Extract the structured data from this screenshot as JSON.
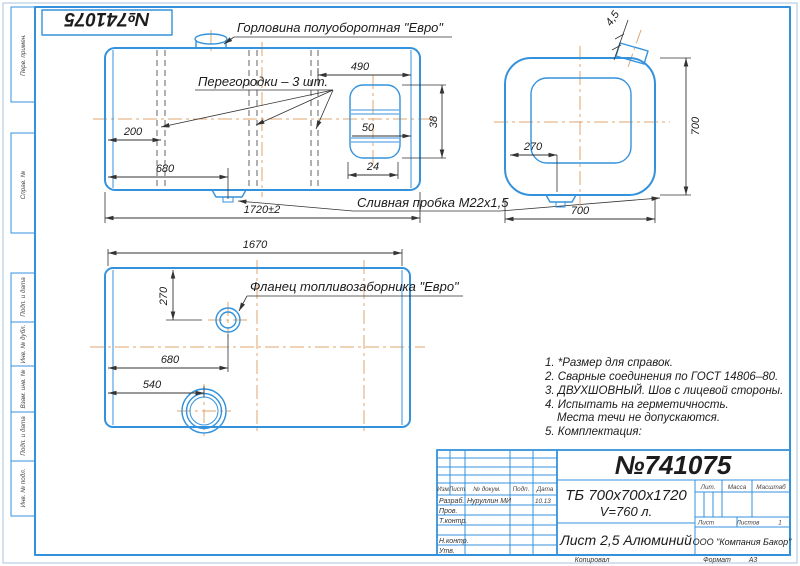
{
  "stamp": {
    "number": "№741075"
  },
  "margin": {
    "labels": [
      "Перв. примен.",
      "Справ. №",
      "Подп. и дата",
      "Инв. № дубл.",
      "Взам. инв. №",
      "Подп. и дата",
      "Инв. № подл."
    ]
  },
  "drawing": {
    "callouts": {
      "neck": "Горловина полуоборотная \"Евро\"",
      "partitions": "Перегородки – 3 шт.",
      "drain": "Сливная пробка М22х1,5",
      "flange": "Фланец топливозаборника \"Евро\""
    },
    "dims": {
      "front_490": "490",
      "front_200": "200",
      "front_680": "680",
      "front_len": "1720±2",
      "front_50": "50",
      "front_24": "24",
      "front_38": "38",
      "end_h": "700",
      "end_w": "700",
      "end_270": "270",
      "end_wall": "4,5",
      "bottom_len": "1670",
      "bottom_270": "270",
      "bottom_680": "680",
      "bottom_540": "540"
    }
  },
  "notes": [
    "1. *Размер для справок.",
    "2. Сварные соединения по ГОСТ 14806–80.",
    "3. ДВУХШОВНЫЙ. Шов с лицевой стороны.",
    "4. Испытать на герметичность.",
    "Места течи не допускаются.",
    "5. Комплектация:"
  ],
  "title_block": {
    "number": "№741075",
    "designation": "ТБ 700х700х1720",
    "volume": "V=760 л.",
    "material": "Лист 2,5 Алюминий",
    "company": "ООО \"Компания Бакор\"",
    "headers": {
      "izm": "Изм",
      "list": "Лист",
      "doc": "№ докум.",
      "podp": "Подп.",
      "data": "Дата",
      "lit": "Лит.",
      "massa": "Масса",
      "masshtab": "Масштаб",
      "sheet": "Лист",
      "sheets": "Листов"
    },
    "sheets_value": "1",
    "sig_rows": [
      {
        "label": "Разраб.",
        "name": "Нуруллин МИ",
        "date": "10.13"
      },
      {
        "label": "Пров.",
        "name": "",
        "date": ""
      },
      {
        "label": "Т.контр.",
        "name": "",
        "date": ""
      },
      {
        "label": "Н.контр.",
        "name": "",
        "date": ""
      },
      {
        "label": "Утв.",
        "name": "",
        "date": ""
      }
    ],
    "footer": {
      "copied": "Копировал",
      "format_label": "Формат",
      "format_value": "А3"
    }
  },
  "colors": {
    "line_blue": "#3492dc",
    "centerline": "#e2a76f",
    "ink": "#1c1c1c"
  }
}
